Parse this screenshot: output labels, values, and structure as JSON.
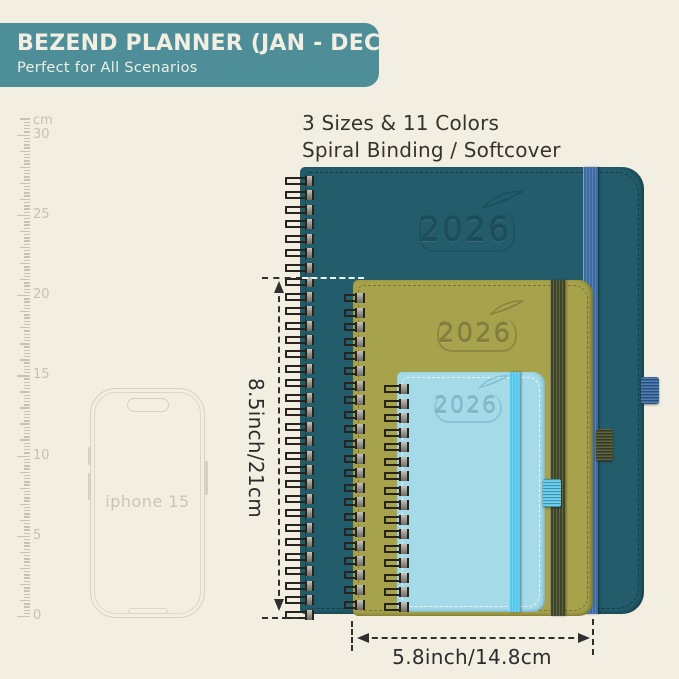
{
  "banner": {
    "title": "BEZEND PLANNER (JAN - DEC)",
    "subtitle": "Perfect for All Scenarios",
    "bg_color": "#4d8e98"
  },
  "info": {
    "line1": "3 Sizes & 11 Colors",
    "line2": "Spiral Binding / Softcover"
  },
  "ruler": {
    "unit_label": "cm",
    "major_labels": [
      "30",
      "25",
      "20",
      "15",
      "10",
      "5",
      "0"
    ]
  },
  "phone": {
    "label": "iphone 15"
  },
  "planners": {
    "large": {
      "year": "2026",
      "cover_color": "#235d6c",
      "elastic_color": "#3c6ba4",
      "spiral_rings": 31
    },
    "medium": {
      "year": "2026",
      "cover_color": "#a7a24c",
      "elastic_color": "#3f4526",
      "spiral_rings": 22
    },
    "small": {
      "year": "2026",
      "cover_color": "#a5dbe9",
      "elastic_color": "#54c8ea",
      "spiral_rings": 16
    }
  },
  "dimensions": {
    "height_label": "8.5inch/21cm",
    "width_label": "5.8inch/14.8cm"
  },
  "colors": {
    "background": "#f3eee2",
    "annotation": "#2f2f2f"
  }
}
